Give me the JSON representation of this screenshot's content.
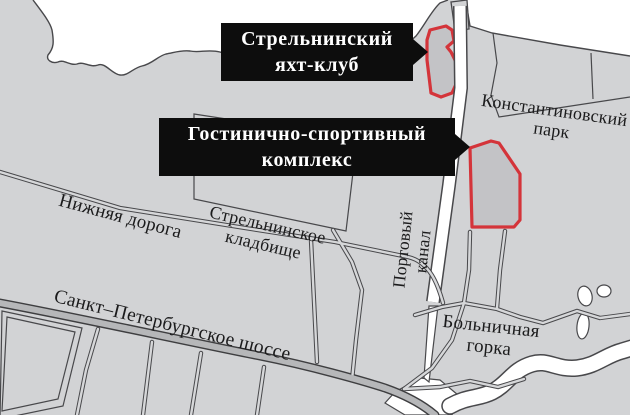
{
  "colors": {
    "bg": "#d2d3d5",
    "water": "#ffffff",
    "line": "#48484b",
    "road_fill": "#d6d7d9",
    "highway_fill": "#b6b7b9",
    "highlight_border": "#d4343a",
    "highlight_fill": "#c3c3c6",
    "callout_bg": "#0d0d0d",
    "callout_text": "#ffffff",
    "label_color": "#1b1b1c"
  },
  "callouts": {
    "yacht_club": {
      "lines": [
        "Стрельнинский",
        "яхт-клуб"
      ]
    },
    "hotel_complex": {
      "lines": [
        "Гостинично-спортивный",
        "комплекс"
      ]
    }
  },
  "labels": {
    "park": {
      "lines": [
        "Константиновский",
        "парк"
      ]
    },
    "nizhnyaya_doroga": {
      "text": "Нижняя дорога"
    },
    "cemetery": {
      "lines": [
        "Стрельнинское",
        "кладбище"
      ]
    },
    "portovy_kanal": {
      "lines": [
        "Портовый",
        "канал"
      ]
    },
    "shosse": {
      "text": "Санкт–Петербургское шоссе"
    },
    "bolnichnaya_gorka": {
      "lines": [
        "Больничная",
        "горка"
      ]
    }
  }
}
